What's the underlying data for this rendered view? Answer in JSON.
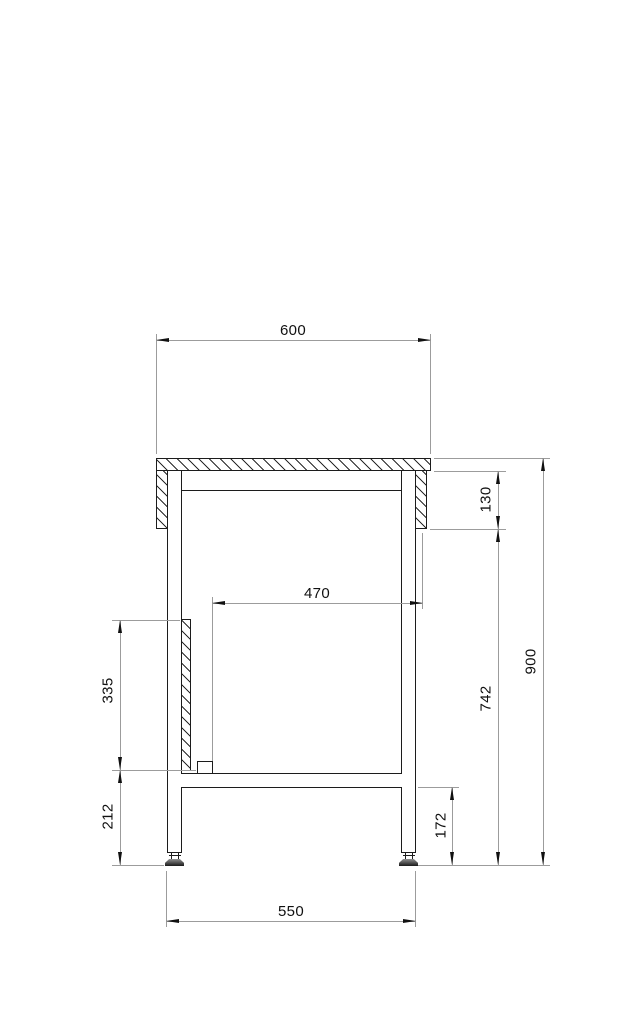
{
  "drawing": {
    "type": "technical-side-elevation",
    "subject": "workbench cross-section",
    "colors": {
      "outline": "#1c1c1c",
      "dimension_lines": "#9c9c9c",
      "text": "#111111",
      "background": "#ffffff"
    },
    "dimensions": {
      "top_width": "600",
      "inner_clearance": "470",
      "apron_height": "130",
      "overall_height": "900",
      "under_top_height": "742",
      "panel_height": "335",
      "panel_bottom_to_floor": "212",
      "shelf_bottom_height": "172",
      "leg_outer_span": "550"
    }
  }
}
